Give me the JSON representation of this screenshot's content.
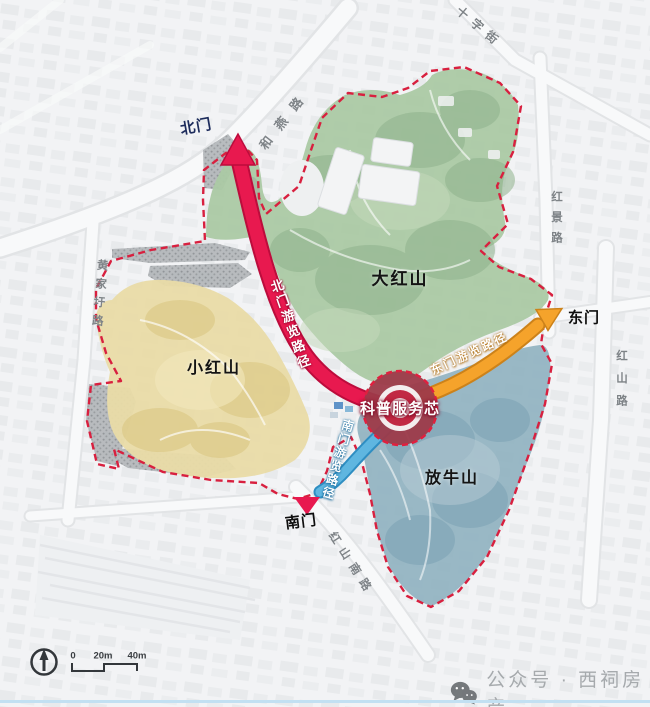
{
  "map_title": "红山公园游览路径规划图",
  "zones": [
    {
      "id": "dahongshan",
      "label": "大红山",
      "color": "#abc9a4"
    },
    {
      "id": "xiaohongshan",
      "label": "小红山",
      "color": "#e9dba6"
    },
    {
      "id": "fangniushan",
      "label": "放牛山",
      "color": "#93b4c2"
    }
  ],
  "gates": [
    {
      "id": "north-gate",
      "label": "北门"
    },
    {
      "id": "east-gate",
      "label": "东门"
    },
    {
      "id": "south-gate",
      "label": "南门"
    }
  ],
  "routes": [
    {
      "id": "north-route",
      "label": "北门游览路径",
      "color": "#e8194f"
    },
    {
      "id": "east-route",
      "label": "东门游览路径",
      "color": "#f5a32b"
    },
    {
      "id": "south-route",
      "label": "南门游览路径",
      "color": "#5fb6e0"
    }
  ],
  "center_node": {
    "label": "科普服务芯",
    "color": "#c12944"
  },
  "boundary_color": "#d8203f",
  "roads": [
    {
      "label": "十字街"
    },
    {
      "label": "和燕路"
    },
    {
      "label": "红景路"
    },
    {
      "label": "红山路"
    },
    {
      "label": "黄家圩路"
    },
    {
      "label": "红山南路"
    }
  ],
  "legend": {
    "scale_ticks": [
      "0",
      "20m",
      "40m"
    ]
  },
  "watermark": {
    "label": "公众号 · 西祠房产"
  }
}
